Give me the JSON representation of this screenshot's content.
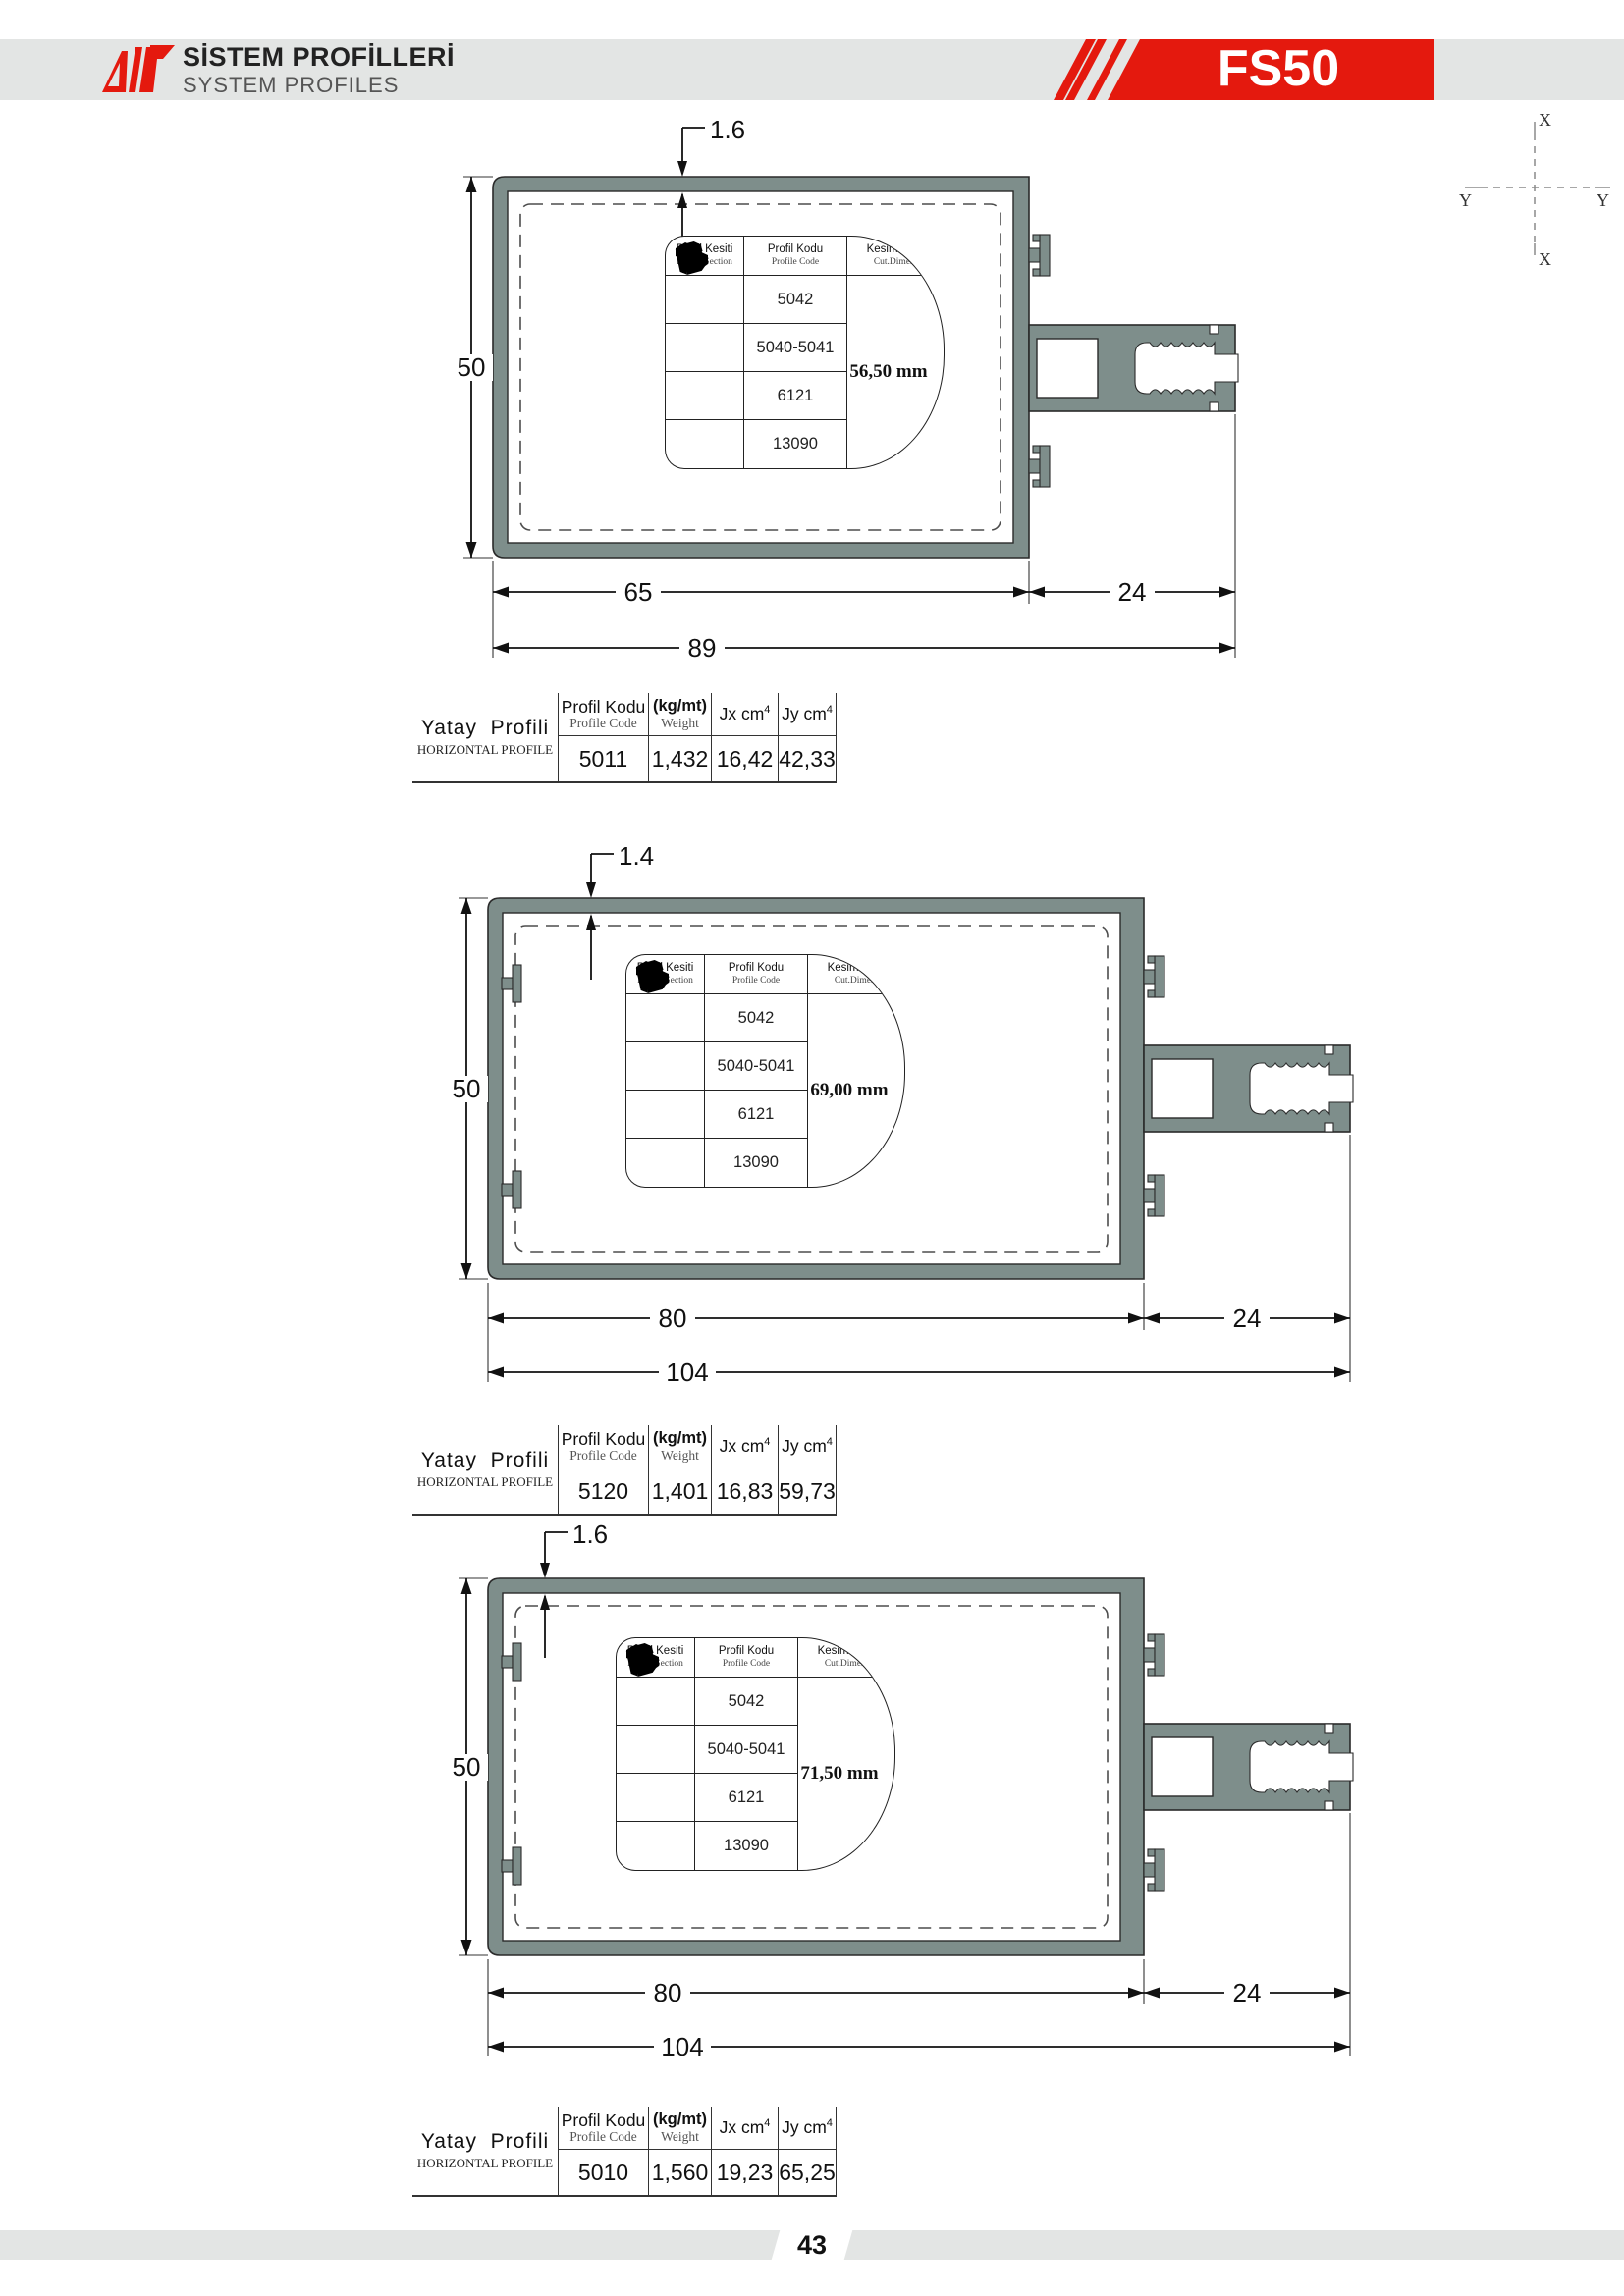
{
  "header": {
    "title_tr": "SİSTEM PROFİLLERİ",
    "title_en": "SYSTEM PROFILES",
    "badge": "FS50"
  },
  "axis": {
    "x": "X",
    "y": "Y"
  },
  "blob": {
    "c1_tr": "Profil Kesiti",
    "c1_en": "Profile Section",
    "c2_tr": "Profil Kodu",
    "c2_en": "Profile Code",
    "c3_tr": "Kesim Ölçü",
    "c3_en": "Cut.Dimen.",
    "codes": [
      "5042",
      "5040-5041",
      "6121",
      "13090"
    ]
  },
  "dt": {
    "title_tr": "Yatay  Profili",
    "title_en": "HORIZONTAL PROFILE",
    "code_tr": "Profil Kodu",
    "code_en": "Profile Code",
    "w_tr": "(kg/mt)",
    "w_en": "Weight",
    "jx": "Jx cm",
    "jy": "Jy cm",
    "sup": "4"
  },
  "profiles": [
    {
      "cut": "56,50 mm",
      "top": "1.6",
      "left": "50",
      "width": "65",
      "ext": "24",
      "total": "89",
      "code": "5011",
      "weight": "1,432",
      "jx": "16,42",
      "jy": "42,33"
    },
    {
      "cut": "69,00 mm",
      "top": "1.4",
      "left": "50",
      "width": "80",
      "ext": "24",
      "total": "104",
      "code": "5120",
      "weight": "1,401",
      "jx": "16,83",
      "jy": "59,73"
    },
    {
      "cut": "71,50 mm",
      "top": "1.6",
      "left": "50",
      "width": "80",
      "ext": "24",
      "total": "104",
      "code": "5010",
      "weight": "1,560",
      "jx": "19,23",
      "jy": "65,25"
    }
  ],
  "footer": {
    "page": "43"
  },
  "colors": {
    "profile_fill": "#7e8e8b",
    "accent_red": "#e4190e",
    "band_gray": "#e3e5e4"
  }
}
